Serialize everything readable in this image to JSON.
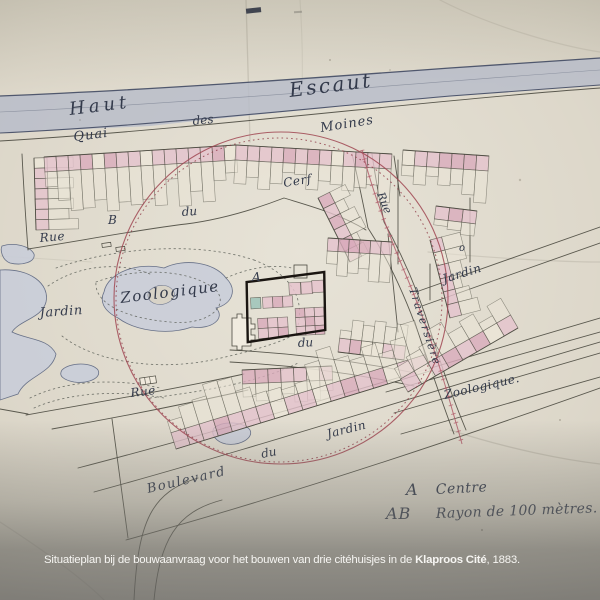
{
  "colors": {
    "paper": "#dad4c6",
    "ink": "#4b4a40",
    "text_ink": "#333a4b",
    "river": "#b7bbc9",
    "water": "#c8ccd9",
    "house_pink": "#e5c3cd",
    "house_pink_dark": "#d9abbb",
    "house_back": "#ece6d8",
    "circle_red": "#a04652",
    "tram_red": "#b05a68",
    "teal": "#9dc3b9",
    "black_rect": "#1a1511",
    "caption_text": "#f6f5f2"
  },
  "map": {
    "river": {
      "left": "Haut",
      "right": "Escaut"
    },
    "quai": {
      "w1": "Quai",
      "w2": "des",
      "w3": "Moines"
    },
    "streets": {
      "rue_left": "Rue",
      "cerf_du": "du",
      "cerf": "Cerf",
      "trav_rue": "Rue",
      "traversiere": "Traversière",
      "jardin_right": "Jardin",
      "zoologique_right": "Zoologique.",
      "du_mid": "du",
      "rue_bottom": "Rue",
      "blvd_jardin": "Jardin",
      "blvd_du": "du",
      "boulevard": "Boulevard"
    },
    "park": {
      "jardin": "Jardin",
      "zoologique": "Zoologique"
    },
    "markers": {
      "a": "A",
      "b": "B",
      "o": "o"
    },
    "legend": {
      "a": "A",
      "a_desc": "Centre",
      "ab": "AB",
      "ab_desc": "Rayon de 100 mètres."
    }
  },
  "caption": {
    "before": "Situatieplan bij de bouwaanvraag voor het bouwen van drie citéhuisjes in de ",
    "highlight": "Klaproos Cité",
    "after": ", 1883."
  }
}
